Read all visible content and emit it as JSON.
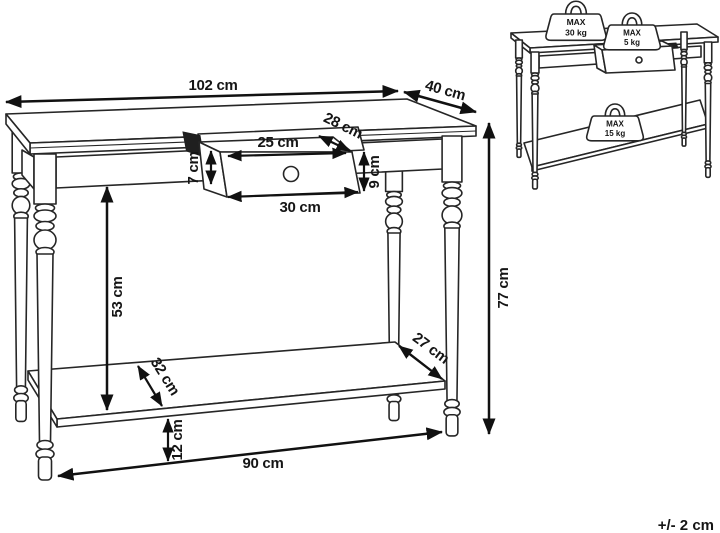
{
  "drawing": {
    "subject": "console table with drawer and lower shelf — dimension diagram"
  },
  "dimensions": {
    "top_width": "102 cm",
    "top_depth": "40 cm",
    "drawer_opening_depth": "28 cm",
    "drawer_top_width": "25 cm",
    "drawer_side_height": "7 cm",
    "drawer_front_height": "9 cm",
    "drawer_bottom_width": "30 cm",
    "under_top_clearance": "53 cm",
    "total_height": "77 cm",
    "shelf_depth_right": "27 cm",
    "shelf_depth_left": "32 cm",
    "shelf_floor_height": "12 cm",
    "between_legs_width": "90 cm"
  },
  "max_loads": {
    "tabletop": {
      "line1": "MAX",
      "line2": "30 kg"
    },
    "drawer": {
      "line1": "MAX",
      "line2": "5 kg"
    },
    "shelf": {
      "line1": "MAX",
      "line2": "15 kg"
    }
  },
  "footer": {
    "tolerance": "+/- 2 cm"
  },
  "colors": {
    "line": "#1a1a1a",
    "background": "#ffffff"
  }
}
